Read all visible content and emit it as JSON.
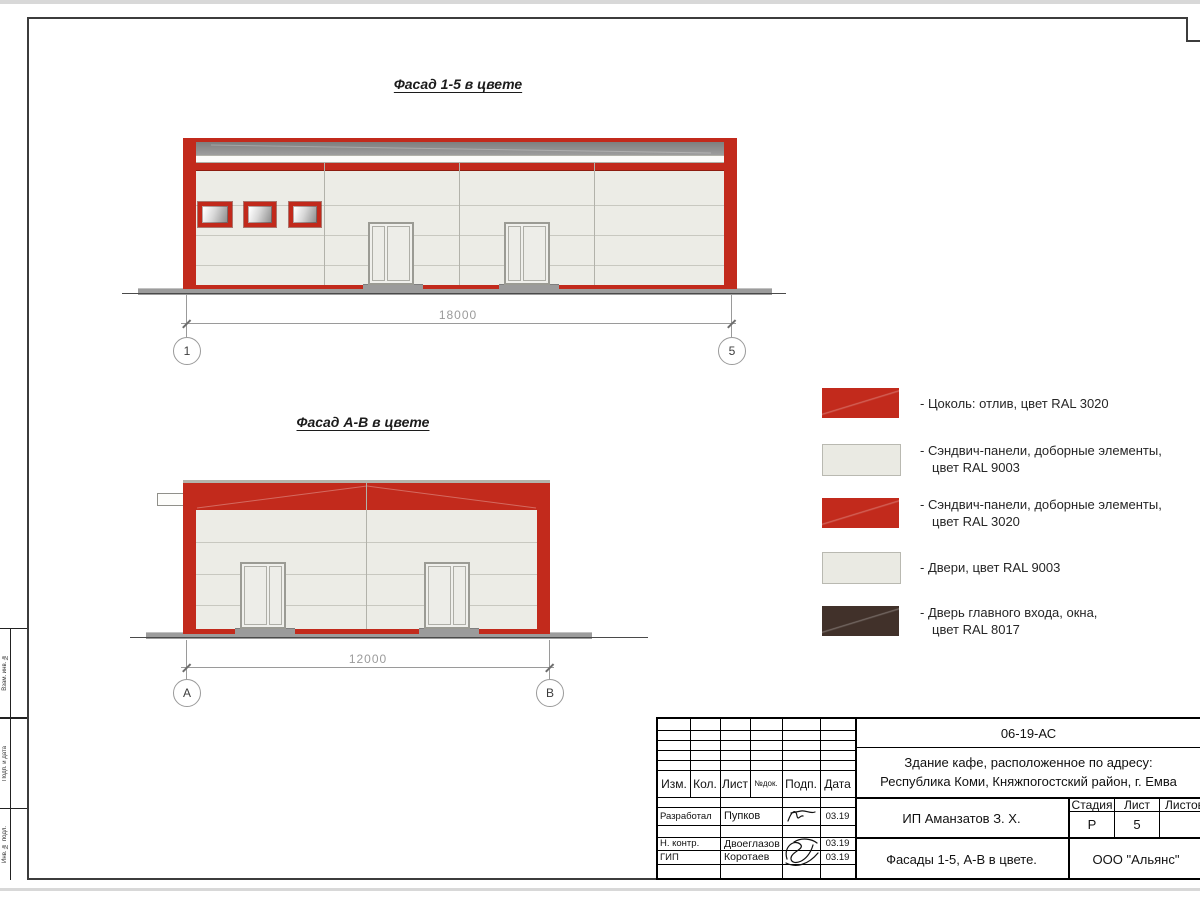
{
  "facades": {
    "top": {
      "title": "Фасад 1-5 в цвете",
      "dim": "18000",
      "axis_left": "1",
      "axis_right": "5"
    },
    "bottom": {
      "title": "Фасад А-В в цвете",
      "dim": "12000",
      "axis_left": "А",
      "axis_right": "В"
    }
  },
  "legend": {
    "items": [
      {
        "color": "#c22a1c",
        "line1": "- Цоколь: отлив, цвет RAL 3020",
        "line2": ""
      },
      {
        "color": "#eaeae3",
        "line1": "- Сэндвич-панели, доборные элементы,",
        "line2": "цвет RAL 9003"
      },
      {
        "color": "#c22a1c",
        "line1": "- Сэндвич-панели, доборные элементы,",
        "line2": "цвет RAL 3020"
      },
      {
        "color": "#eaeae3",
        "line1": "- Двери, цвет RAL 9003",
        "line2": ""
      },
      {
        "color": "#41312a",
        "line1": "- Дверь главного входа, окна,",
        "line2": "цвет RAL 8017"
      }
    ]
  },
  "stamp": {
    "doc_number": "06-19-АС",
    "object_line1": "Здание кафе, расположенное по адресу:",
    "object_line2": "Республика Коми, Княжпогостский район, г. Емва",
    "client": "ИП Аманзатов З. Х.",
    "sheet_name": "Фасады 1-5, А-В в цвете.",
    "company": "ООО \"Альянс\"",
    "stage_label": "Стадия",
    "list_label": "Лист",
    "listov_label": "Листов",
    "stage": "Р",
    "list": "5",
    "listov": "",
    "head": {
      "izm": "Изм.",
      "kol": "Кол.",
      "list": "Лист",
      "ndok": "№док.",
      "podp": "Подп.",
      "data": "Дата"
    },
    "signers": [
      {
        "role": "Разработал",
        "name": "Пупков",
        "date": "03.19"
      },
      {
        "role": "Н. контр.",
        "name": "Двоеглазов",
        "date": "03.19"
      },
      {
        "role": "ГИП",
        "name": "Коротаев",
        "date": "03.19"
      }
    ]
  },
  "side_stamp": {
    "labels": [
      "Взам. инв. №",
      "Подп. и дата",
      "Инв. № подл."
    ]
  }
}
